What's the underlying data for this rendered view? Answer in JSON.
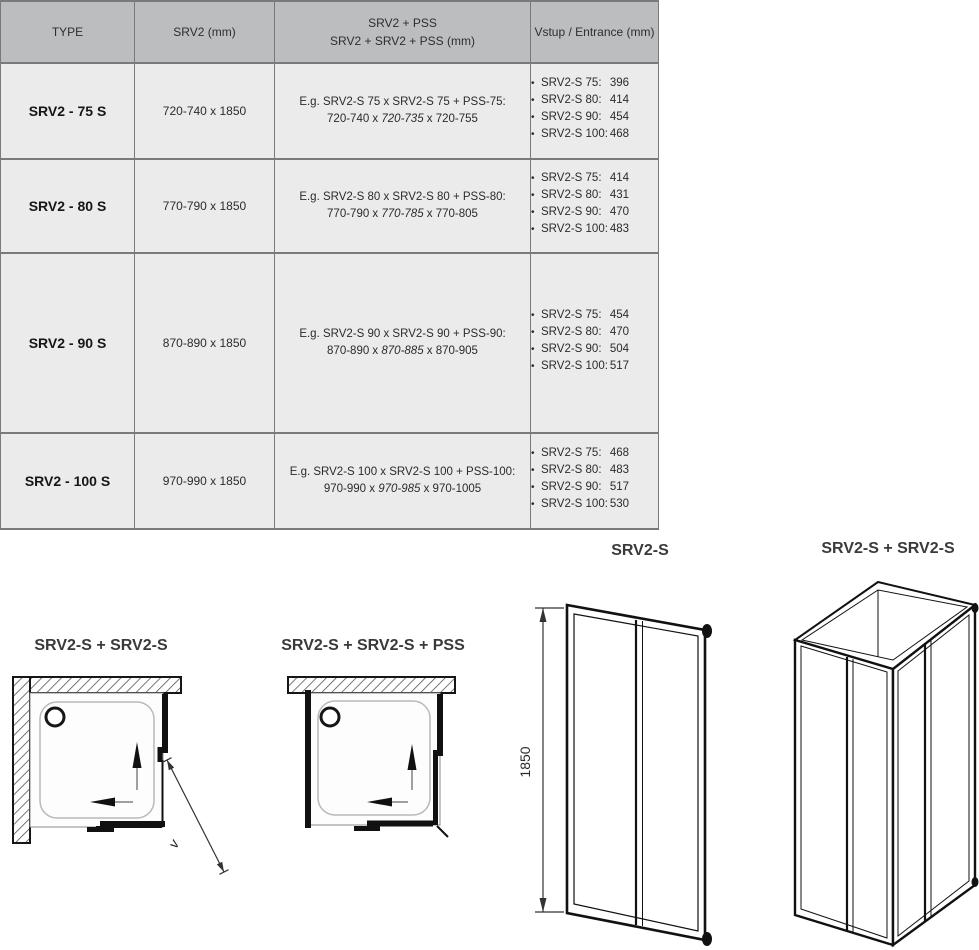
{
  "icons": {
    "bullet": "•"
  },
  "colors": {
    "header_bg": "#bcbdbf",
    "row_bg": "#ebebec",
    "table_border": "#797a7c",
    "diagram_line": "#161616",
    "label_text": "#3a3a3a"
  },
  "table": {
    "header": {
      "type": "TYPE",
      "srv2": "SRV2 (mm)",
      "combo_line1": "SRV2 + PSS",
      "combo_line2": "SRV2 + SRV2 + PSS (mm)",
      "entrance": "Vstup / Entrance (mm)"
    },
    "rows": [
      {
        "type": "SRV2 - 75 S",
        "size": "720-740 x 1850",
        "example_line1": "E.g. SRV2-S 75 x SRV2-S 75 + PSS-75:",
        "example_prefix": "720-740 x ",
        "example_mid_italic": "720-735",
        "example_suffix": " x 720-755",
        "entrance": [
          {
            "label": "SRV2-S 75:",
            "value": "396"
          },
          {
            "label": "SRV2-S 80:",
            "value": "414"
          },
          {
            "label": "SRV2-S 90:",
            "value": "454"
          },
          {
            "label": "SRV2-S 100:",
            "value": "468"
          }
        ]
      },
      {
        "type": "SRV2 - 80 S",
        "size": "770-790 x 1850",
        "example_line1": "E.g. SRV2-S 80 x SRV2-S 80 + PSS-80:",
        "example_prefix": "770-790 x ",
        "example_mid_italic": "770-785",
        "example_suffix": " x 770-805",
        "entrance": [
          {
            "label": "SRV2-S 75:",
            "value": "414"
          },
          {
            "label": "SRV2-S 80:",
            "value": "431"
          },
          {
            "label": "SRV2-S 90:",
            "value": "470"
          },
          {
            "label": "SRV2-S 100:",
            "value": "483"
          }
        ]
      },
      {
        "type": "SRV2 - 90 S",
        "size": "870-890 x 1850",
        "example_line1": "E.g. SRV2-S 90 x SRV2-S 90 + PSS-90:",
        "example_prefix": "870-890 x ",
        "example_mid_italic": "870-885",
        "example_suffix": " x 870-905",
        "entrance": [
          {
            "label": "SRV2-S 75:",
            "value": "454"
          },
          {
            "label": "SRV2-S 80:",
            "value": "470"
          },
          {
            "label": "SRV2-S 90:",
            "value": "504"
          },
          {
            "label": "SRV2-S 100:",
            "value": "517"
          }
        ]
      },
      {
        "type": "SRV2 - 100 S",
        "size": "970-990 x 1850",
        "example_line1": "E.g. SRV2-S 100 x SRV2-S 100 + PSS-100:",
        "example_prefix": "970-990 x ",
        "example_mid_italic": "970-985",
        "example_suffix": " x 970-1005",
        "entrance": [
          {
            "label": "SRV2-S 75:",
            "value": "468"
          },
          {
            "label": "SRV2-S 80:",
            "value": "483"
          },
          {
            "label": "SRV2-S 90:",
            "value": "517"
          },
          {
            "label": "SRV2-S 100:",
            "value": "530"
          }
        ]
      }
    ]
  },
  "diagrams": {
    "plan_corner": {
      "title": "SRV2-S + SRV2-S",
      "entry_label": "v"
    },
    "plan_wall_pss": {
      "title": "SRV2-S + SRV2-S + PSS"
    },
    "door_elevation": {
      "title": "SRV2-S",
      "height_mm": "1850"
    },
    "corner_3d": {
      "title": "SRV2-S + SRV2-S"
    }
  }
}
